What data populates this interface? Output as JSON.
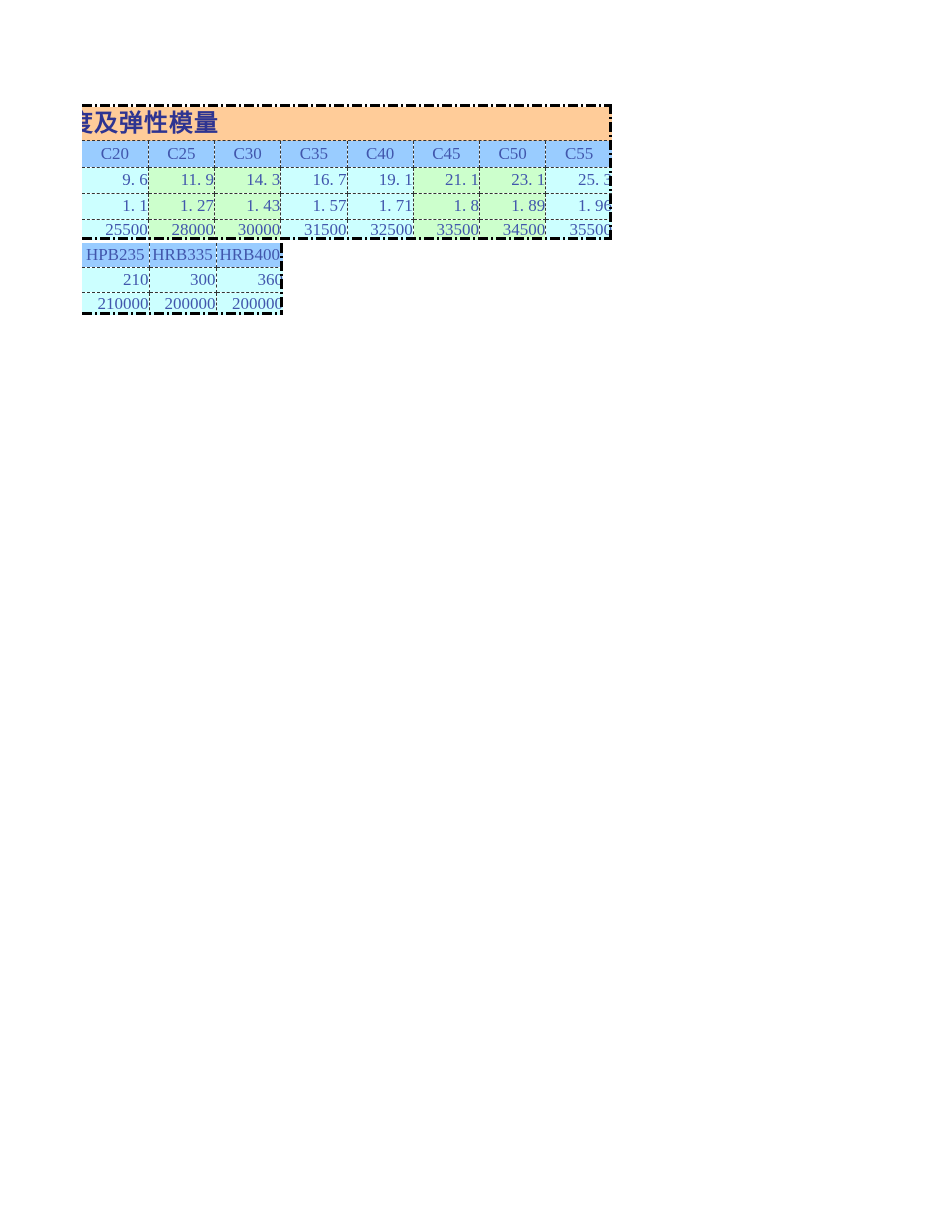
{
  "colors": {
    "canvas_bg": "#FFFFFF",
    "title_bg": "#FFCC99",
    "header_bg": "#99CCFF",
    "cyan_bg": "#CCFFFF",
    "green_bg": "#CCFFCC",
    "title_text": "#2E3491",
    "cell_text": "#4156AC",
    "border_color": "#000000"
  },
  "concrete_table": {
    "title": "度及弹性模量",
    "headers": [
      "C20",
      "C25",
      "C30",
      "C35",
      "C40",
      "C45",
      "C50",
      "C55"
    ],
    "rows": [
      [
        "9. 6",
        "11. 9",
        "14. 3",
        "16. 7",
        "19. 1",
        "21. 1",
        "23. 1",
        "25. 3"
      ],
      [
        "1. 1",
        "1. 27",
        "1. 43",
        "1. 57",
        "1. 71",
        "1. 8",
        "1. 89",
        "1. 96"
      ],
      [
        "25500",
        "28000",
        "30000",
        "31500",
        "32500",
        "33500",
        "34500",
        "35500"
      ]
    ]
  },
  "steel_table": {
    "headers": [
      "HPB235",
      "HRB335",
      "HRB400"
    ],
    "rows": [
      [
        "210",
        "300",
        "360"
      ],
      [
        "210000",
        "200000",
        "200000"
      ]
    ]
  }
}
